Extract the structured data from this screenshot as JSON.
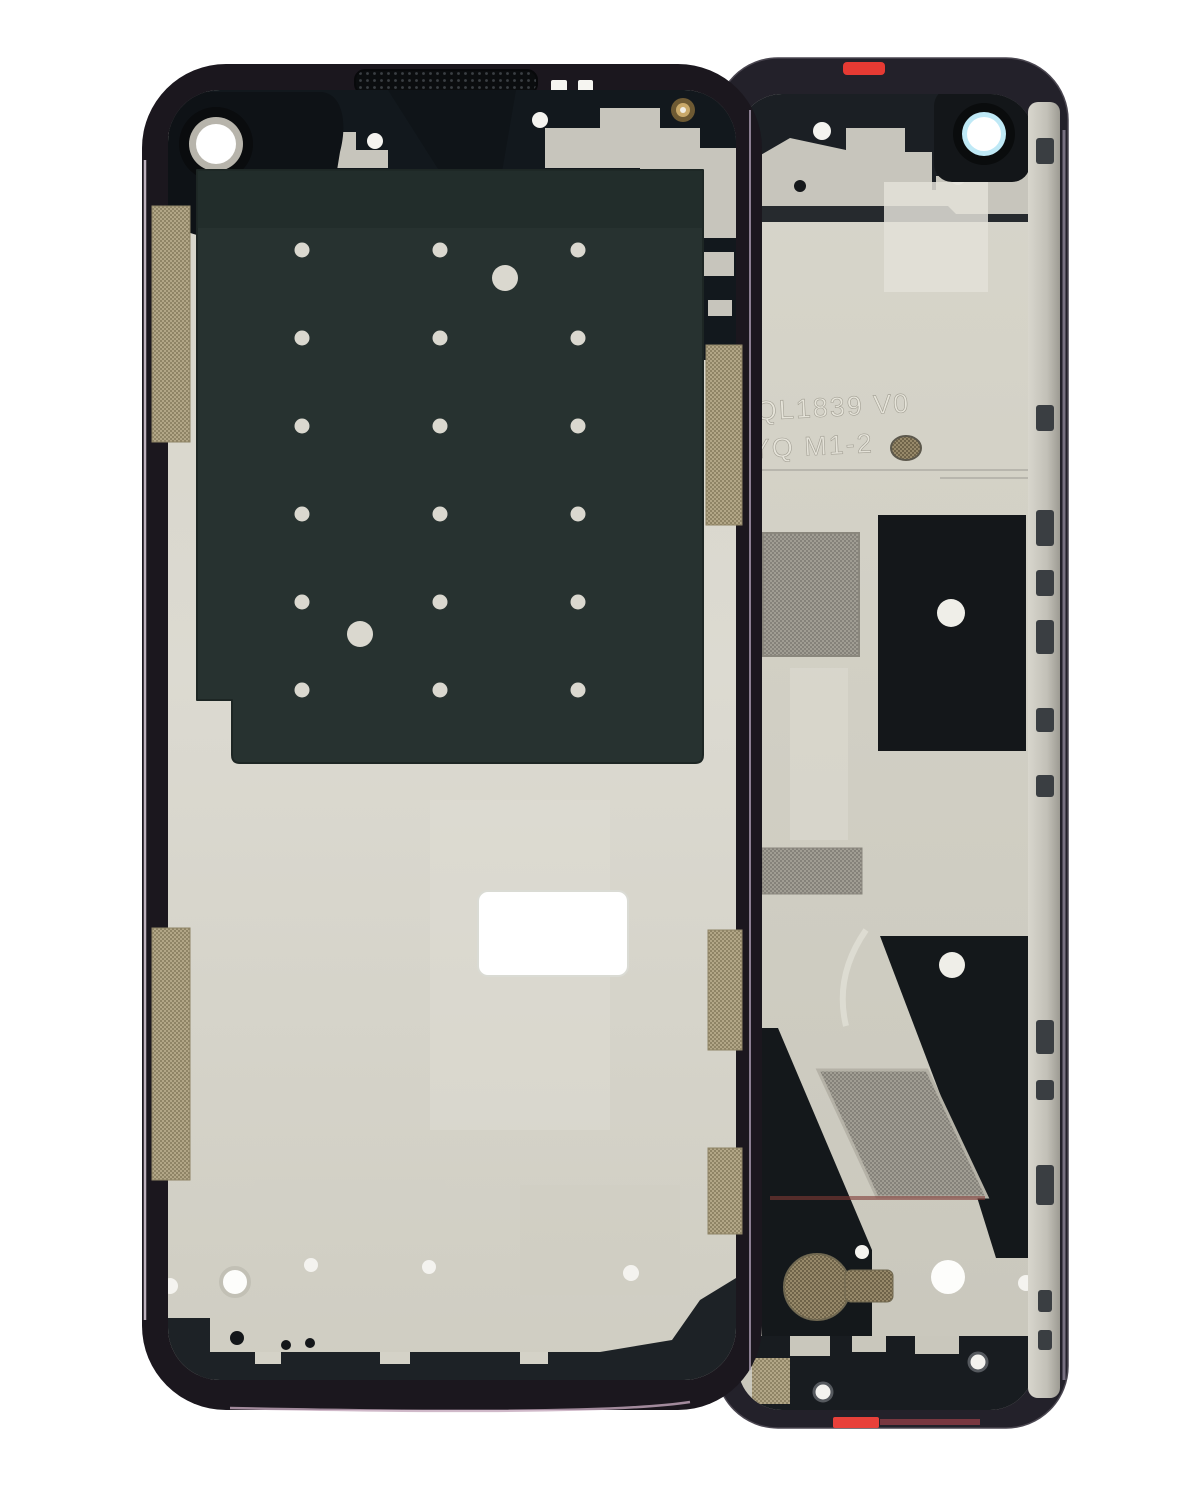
{
  "scene": {
    "type": "product-photo",
    "subject": "Two smartphone mid-frame (front housing) replacement parts shown front and back on a plain white background",
    "background_color": "#ffffff"
  },
  "embossed_markings": {
    "line1": "QL1839 V0",
    "line2": "YQ M1-2"
  },
  "left_frame": {
    "view": "front side of mid-frame (display facing side)",
    "bezel_color": "#1b171e",
    "bezel_highlight_color": "#cbbccb",
    "plate_color": "#d8d6cb",
    "graphite_sheet_color": "#273230",
    "features": [
      "front camera opening top-left",
      "earpiece speaker grille on top bezel",
      "large graphite adhesive sheet with grid of alignment holes",
      "two larger alignment holes in sheet",
      "blank white rectangular label sticker",
      "tan antenna mesh strips on left and right edges",
      "black bottom adhesive strip",
      "screw holes along top and bottom"
    ],
    "hole_grid": {
      "columns": 3,
      "rows": 6
    }
  },
  "right_frame": {
    "view": "back side of mid-frame (chassis side)",
    "bezel_color": "#23212a",
    "plate_color": "#d2d0c5",
    "features": [
      "rear camera opening with blue iridescent lens ring top-right",
      "red pull tab on top edge",
      "embossed mold markings on plate",
      "black adhesive panel with round opening",
      "gray mesh fabric antenna patches",
      "large diagonal black adhesive shapes",
      "coin vibration motor bottom-left",
      "silver side rail with button and port cutouts",
      "red adhesive tab on bottom edge"
    ]
  },
  "colors": {
    "mesh_tan": "#b2a687",
    "mesh_gray": "#a09d93",
    "mesh_bronze": "#97896a",
    "black_adhesive": "#14181b",
    "camera_ring_cyan": "#bfe9f6",
    "red_tab": "#e63a33",
    "silver_plate": "#c7c5bc",
    "gold_screw": "#c9a96a"
  }
}
